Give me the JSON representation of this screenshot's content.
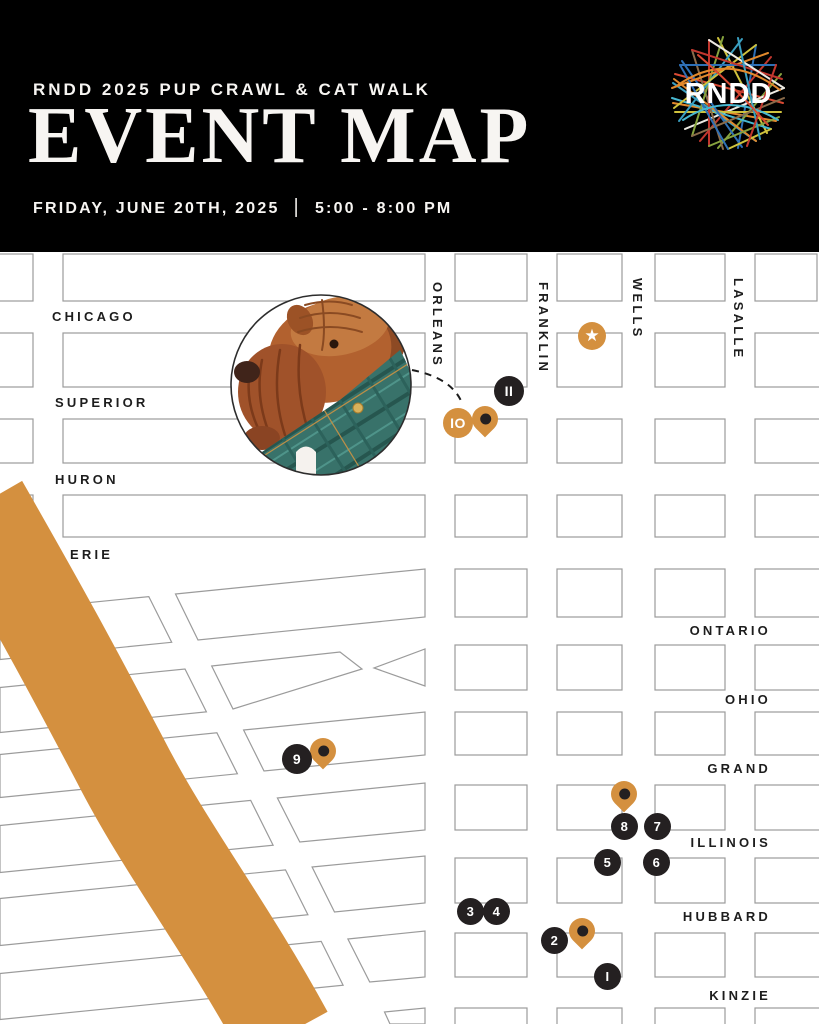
{
  "header": {
    "kicker": "RNDD 2025 PUP CRAWL & CAT WALK",
    "title": "EVENT MAP",
    "date": "FRIDAY, JUNE 20TH, 2025",
    "divider": "|",
    "time": "5:00 - 8:00 PM",
    "logo_text": "RNDD"
  },
  "map": {
    "streets_horizontal": [
      {
        "name": "CHICAGO"
      },
      {
        "name": "SUPERIOR"
      },
      {
        "name": "HURON"
      },
      {
        "name": "ERIE"
      },
      {
        "name": "ONTARIO"
      },
      {
        "name": "OHIO"
      },
      {
        "name": "GRAND"
      },
      {
        "name": "ILLINOIS"
      },
      {
        "name": "HUBBARD"
      },
      {
        "name": "KINZIE"
      }
    ],
    "streets_vertical": [
      {
        "name": "ORLEANS"
      },
      {
        "name": "FRANKLIN"
      },
      {
        "name": "WELLS"
      },
      {
        "name": "LASALLE"
      }
    ],
    "stops": [
      {
        "number": "1"
      },
      {
        "number": "2"
      },
      {
        "number": "3"
      },
      {
        "number": "4"
      },
      {
        "number": "5"
      },
      {
        "number": "6"
      },
      {
        "number": "7"
      },
      {
        "number": "8"
      },
      {
        "number": "9"
      },
      {
        "number": "10",
        "highlighted": true
      },
      {
        "number": "11"
      }
    ],
    "featured_stop": {
      "icon": "star",
      "glyph": "★"
    }
  },
  "colors": {
    "header_background": "#000000",
    "accent_orange": "#D4903F",
    "marker_black": "#242021",
    "map_line_gray": "#9B9B9B",
    "logo_line_colors": [
      "#D94A33",
      "#E2892C",
      "#CFC23D",
      "#3A9FC0",
      "#2E6FB5",
      "#86A33E",
      "#8A6B4A",
      "#EDEAE2"
    ]
  }
}
